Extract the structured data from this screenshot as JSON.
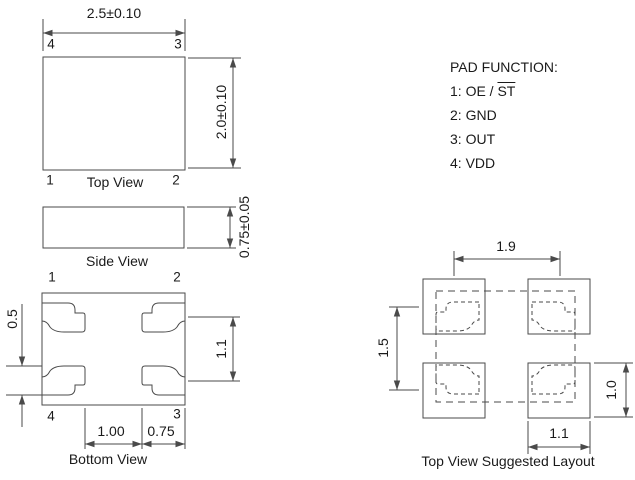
{
  "colors": {
    "line": "#4a4a4a",
    "text": "#1a1a1a",
    "background": "#ffffff"
  },
  "top_view": {
    "label": "Top View",
    "dim_width": "2.5±0.10",
    "dim_height": "2.0±0.10",
    "pin_top_left": "4",
    "pin_top_right": "3",
    "pin_bottom_left": "1",
    "pin_bottom_right": "2"
  },
  "side_view": {
    "label": "Side View",
    "dim_height": "0.75±0.05"
  },
  "bottom_view": {
    "label": "Bottom View",
    "pin_top_left": "1",
    "pin_top_right": "2",
    "pin_bottom_left": "4",
    "pin_bottom_right": "3",
    "dim_pad_height": "0.5",
    "dim_pad_pitch_vertical": "1.1",
    "dim_pad_gap": "1.00",
    "dim_pad_width": "0.75"
  },
  "pad_function": {
    "title": "PAD FUNCTION:",
    "items": [
      {
        "text": "1: OE / ",
        "overline": "ST"
      },
      {
        "text": "2: GND",
        "overline": ""
      },
      {
        "text": "3: OUT",
        "overline": ""
      },
      {
        "text": "4: VDD",
        "overline": ""
      }
    ]
  },
  "suggested_layout": {
    "label": "Top View Suggested Layout",
    "dim_pitch_horizontal": "1.9",
    "dim_pitch_vertical": "1.5",
    "dim_pad_height": "1.0",
    "dim_pad_width": "1.1"
  }
}
